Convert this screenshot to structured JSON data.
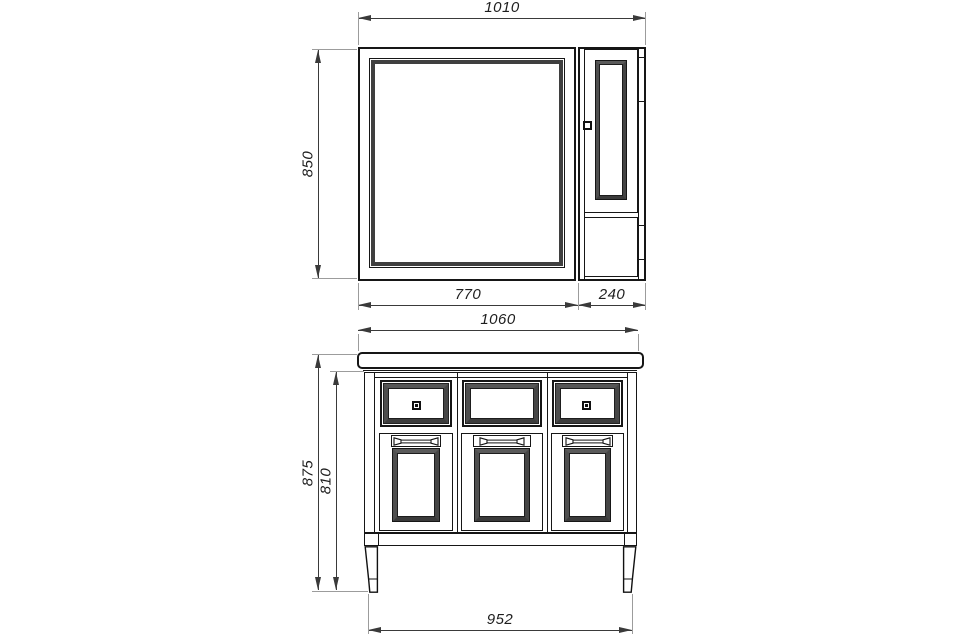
{
  "drawing": {
    "background": "#ffffff",
    "line_color": "#161616",
    "bevel_color": "#3f3f3f",
    "dimension_color": "#3a3a3a",
    "extension_color": "#9c9c9c",
    "mirror_unit": {
      "dims": {
        "total_width": "1010",
        "height": "850",
        "mirror_width": "770",
        "side_cabinet_width": "240"
      }
    },
    "vanity_unit": {
      "dims": {
        "top_width": "1060",
        "total_height": "875",
        "body_height": "810",
        "base_width": "952"
      }
    }
  }
}
